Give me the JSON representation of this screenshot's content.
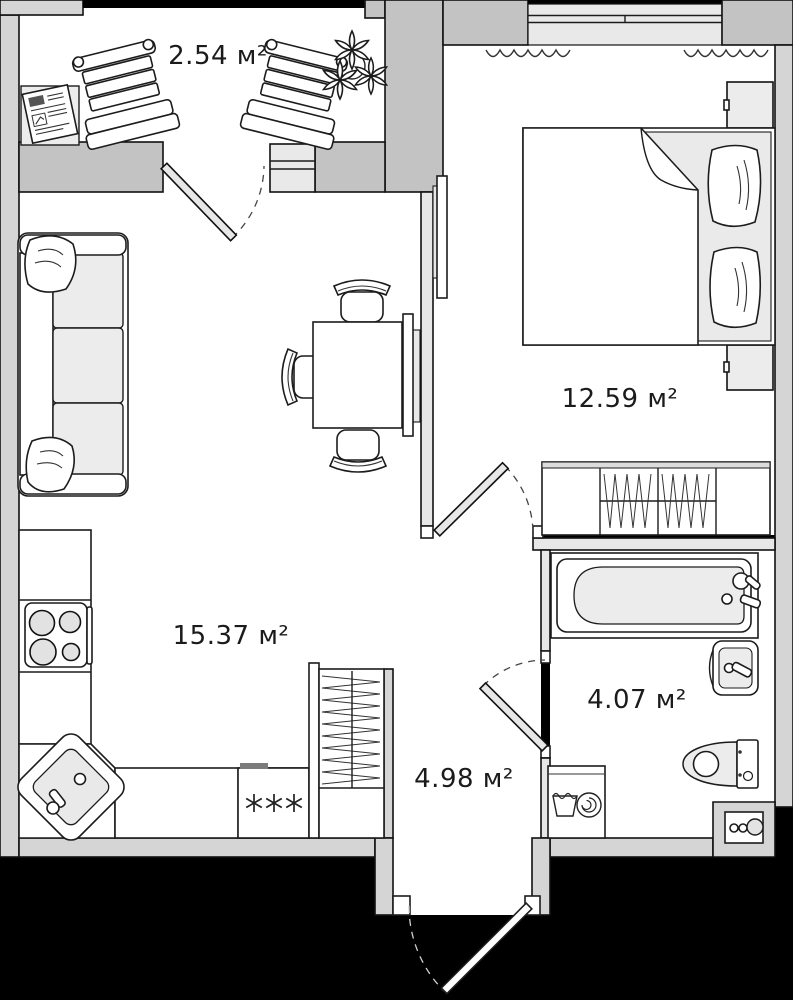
{
  "rooms": [
    {
      "name": "balcony",
      "area_label": "2.54 м²"
    },
    {
      "name": "bedroom",
      "area_label": "12.59 м²"
    },
    {
      "name": "living-kitchen",
      "area_label": "15.37 м²"
    },
    {
      "name": "hallway",
      "area_label": "4.98 м²"
    },
    {
      "name": "bathroom",
      "area_label": "4.07 м²"
    }
  ],
  "colors": {
    "background": "#000000",
    "floor": "#ffffff",
    "wall_outer": "#d5d5d5",
    "wall_heavy": "#c3c3c3",
    "wall_partition": "#e7e7e7",
    "window_glass": "#e9e9e9",
    "furniture_fill": "#ececec",
    "line": "#1a1a1a"
  },
  "icons": [
    "sofa-icon",
    "pillow-icon",
    "dining-table-icon",
    "chair-icon",
    "tv-icon",
    "bed-icon",
    "nightstand-icon",
    "wardrobe-icon",
    "hangers-icon",
    "stove-icon",
    "kitchen-sink-icon",
    "fridge-snowflakes-icon",
    "counter-icon",
    "bathtub-icon",
    "washbasin-icon",
    "toilet-icon",
    "washing-machine-icon",
    "pipe-risers-icon",
    "door-swing-icon",
    "entry-door-icon",
    "window-icon",
    "curtain-icon",
    "plant-icon",
    "deck-chair-icon",
    "side-table-icon",
    "newspaper-icon"
  ]
}
